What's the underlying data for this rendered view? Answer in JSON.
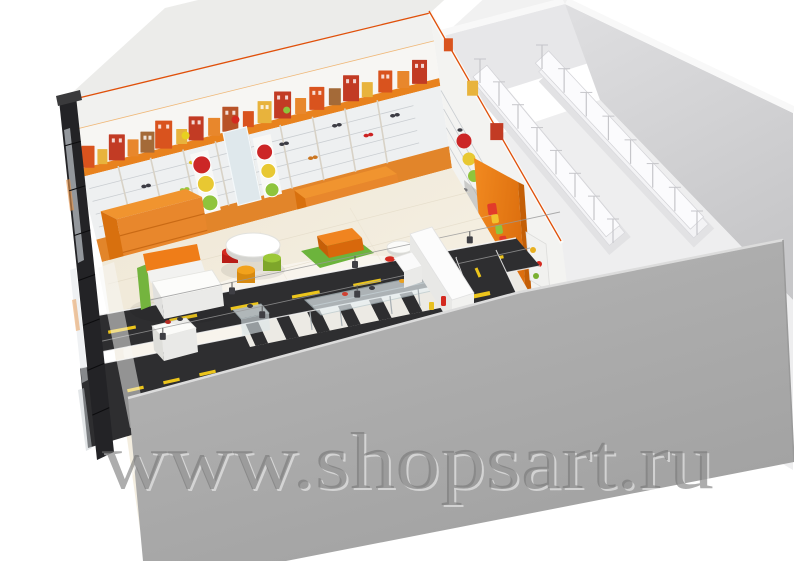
{
  "watermark": {
    "text": "www.shopsart.ru"
  },
  "palette": {
    "background": "#ffffff",
    "facade_wall": "#a9a9a9",
    "glass_dark": "#232326",
    "accent_orange": "#ef821e",
    "wood_orange": "#e8872c",
    "cornice_orange": "#e8821e",
    "trim_red": "#e0500a",
    "road_asphalt": "#2e2e30",
    "marking_yellow": "#ecc51c",
    "marking_white": "#f8f8f8",
    "floor_cream": "#f2ecdf",
    "stock_wall": "#d8d8da",
    "rack_white": "#f7f7f9",
    "rug_green": "#6cb43c",
    "sofa_orange": "#ef7d18",
    "pouf_red": "#d42a20",
    "pouf_orange": "#f2a21c",
    "pouf_green": "#9cc838",
    "traffic_red": "#cc2626",
    "traffic_yellow": "#e8c832",
    "traffic_green": "#8fc43c",
    "mirror_blue": "#dfe8ec"
  },
  "scene": {
    "type": "3d interior render",
    "areas": [
      {
        "id": "sales-area",
        "label": "kids shoe shop sales floor"
      },
      {
        "id": "stockroom",
        "label": "stockroom with white racking"
      }
    ]
  },
  "frieze": {
    "items": [
      [
        0.025,
        13,
        22,
        "#d9531e"
      ],
      [
        0.065,
        10,
        15,
        "#e8b33c"
      ],
      [
        0.105,
        16,
        26,
        "#c23b24"
      ],
      [
        0.15,
        11,
        17,
        "#e8872c"
      ],
      [
        0.19,
        14,
        21,
        "#a46a38"
      ],
      [
        0.235,
        17,
        28,
        "#d9531e"
      ],
      [
        0.285,
        11,
        15,
        "#e8b33c"
      ],
      [
        0.325,
        15,
        24,
        "#c23b24"
      ],
      [
        0.375,
        12,
        18,
        "#e8872c"
      ],
      [
        0.42,
        16,
        25,
        "#b85328"
      ],
      [
        0.47,
        11,
        16,
        "#d9531e"
      ],
      [
        0.515,
        14,
        22,
        "#e8b33c"
      ],
      [
        0.565,
        17,
        27,
        "#c23b24"
      ],
      [
        0.615,
        11,
        16,
        "#e8872c"
      ],
      [
        0.66,
        15,
        23,
        "#d9531e"
      ],
      [
        0.71,
        12,
        17,
        "#a46a38"
      ],
      [
        0.755,
        16,
        26,
        "#c23b24"
      ],
      [
        0.8,
        11,
        15,
        "#e8b33c"
      ],
      [
        0.85,
        14,
        22,
        "#d9531e"
      ],
      [
        0.9,
        12,
        17,
        "#e8872c"
      ],
      [
        0.945,
        15,
        24,
        "#c23b24"
      ]
    ]
  },
  "hanging_items": [
    [
      0.3,
      0.38,
      4,
      "#e8d020"
    ],
    [
      0.44,
      0.36,
      4,
      "#d42a20"
    ],
    [
      0.58,
      0.38,
      3.5,
      "#8fc43c"
    ]
  ],
  "wall_shoes": [
    [
      0.07,
      0.75,
      "#cc2222"
    ],
    [
      0.16,
      0.62,
      "#3c3c44"
    ],
    [
      0.3,
      0.55,
      "#e0c020"
    ],
    [
      0.26,
      0.7,
      "#9cc43c"
    ],
    [
      0.55,
      0.58,
      "#3c3c44"
    ],
    [
      0.62,
      0.71,
      "#cc7722"
    ],
    [
      0.7,
      0.55,
      "#3c3c44"
    ],
    [
      0.78,
      0.66,
      "#cc2222"
    ],
    [
      0.86,
      0.58,
      "#3c3c44"
    ]
  ],
  "traffic_lights": {
    "colors": [
      "#cc2626",
      "#e8c832",
      "#8fc43c"
    ],
    "sets": [
      {
        "u": 0.326,
        "ts": [
          0.58,
          0.7,
          0.82
        ],
        "rs": [
          9,
          8.5,
          8
        ]
      },
      {
        "u": 0.5,
        "ts": [
          0.6,
          0.72,
          0.84
        ],
        "rs": [
          8,
          7.5,
          7
        ]
      }
    ]
  },
  "logo_letters": [
    "#e23b2a",
    "#f2c22e",
    "#8fc43c",
    "#e23b2a",
    "#f2c22e",
    "#8fc43c"
  ],
  "partition_shelf_dots": [
    [
      533,
      250,
      "#e8b020"
    ],
    [
      539,
      264,
      "#d42a20"
    ],
    [
      536,
      276,
      "#7ab030"
    ]
  ],
  "racks": {
    "rows": [
      [
        487,
        86,
        620,
        246
      ],
      [
        549,
        72,
        704,
        238
      ]
    ],
    "posts": 8
  },
  "road": {
    "dashes_a": 7,
    "dashes_b": 4,
    "crosswalk_bars": 9
  },
  "glass": {
    "mullions": 7
  }
}
